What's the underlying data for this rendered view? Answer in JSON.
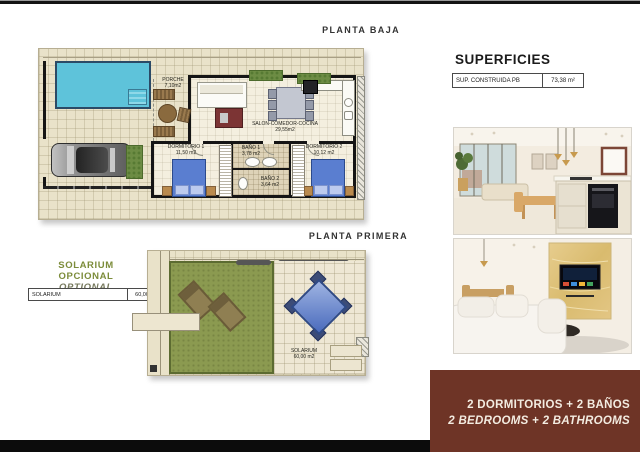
{
  "titles": {
    "ground_floor": "PLANTA BAJA",
    "first_floor": "PLANTA PRIMERA"
  },
  "superficies": {
    "heading": "SUPERFICIES",
    "rows": [
      {
        "label": "SUP. CONSTRUIDA PB",
        "value": "73,38 m²"
      }
    ]
  },
  "solarium_option": {
    "title_es": "SOLARIUM OPCIONAL",
    "title_en": "OPTIONAL SOLARIUM",
    "rows": [
      {
        "label": "SOLARIUM",
        "value": "60,00 m²"
      }
    ]
  },
  "ground_floor": {
    "rooms": {
      "porche": {
        "name": "PORCHE",
        "area": "7,10m2"
      },
      "salon": {
        "name": "SALON-COMEDOR-COCINA",
        "area": "29,55m2"
      },
      "dormitorio1": {
        "name": "DORMITORIO 1",
        "area": "11,50 m2"
      },
      "bano1": {
        "name": "BAÑO 1",
        "area": "3,78 m2"
      },
      "bano2": {
        "name": "BAÑO 2",
        "area": "3,64 m2"
      },
      "dormitorio2": {
        "name": "DORMITORIO 2",
        "area": "10,12 m2"
      }
    }
  },
  "first_floor": {
    "rooms": {
      "solarium": {
        "name": "SOLARIUM",
        "area": "60,00 m2"
      }
    }
  },
  "footer": {
    "line_es": "2 DORMITORIOS + 2 BAÑOS",
    "line_en": "2 BEDROOMS + 2 BATHROOMS"
  },
  "colors": {
    "accent_maroon": "#6e3426",
    "olive_green": "#7c8c3a",
    "pool_blue": "#5ec3da",
    "turf_green": "#8b9a50",
    "plan_beige": "#e9e2c9"
  }
}
